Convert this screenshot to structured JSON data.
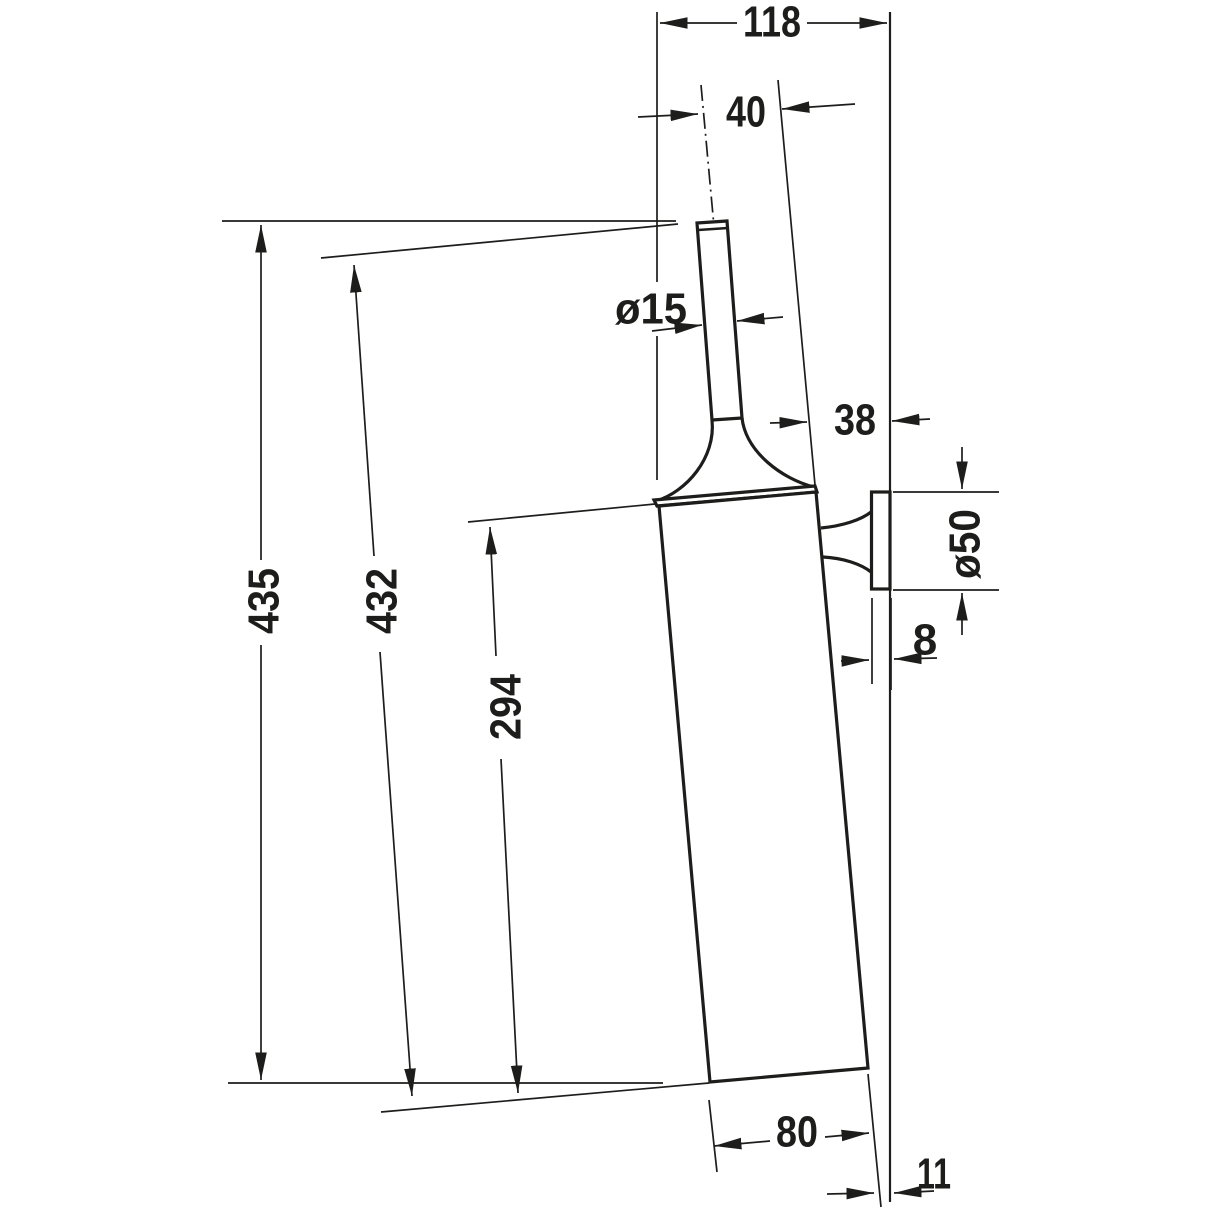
{
  "dimensions": {
    "d118": "118",
    "d40": "40",
    "d15": "ø15",
    "d38": "38",
    "d50": "ø50",
    "d8": "8",
    "d435": "435",
    "d432": "432",
    "d294": "294",
    "d80": "80",
    "d11": "11"
  },
  "colors": {
    "line": "#1d1d1b",
    "background": "#ffffff"
  }
}
